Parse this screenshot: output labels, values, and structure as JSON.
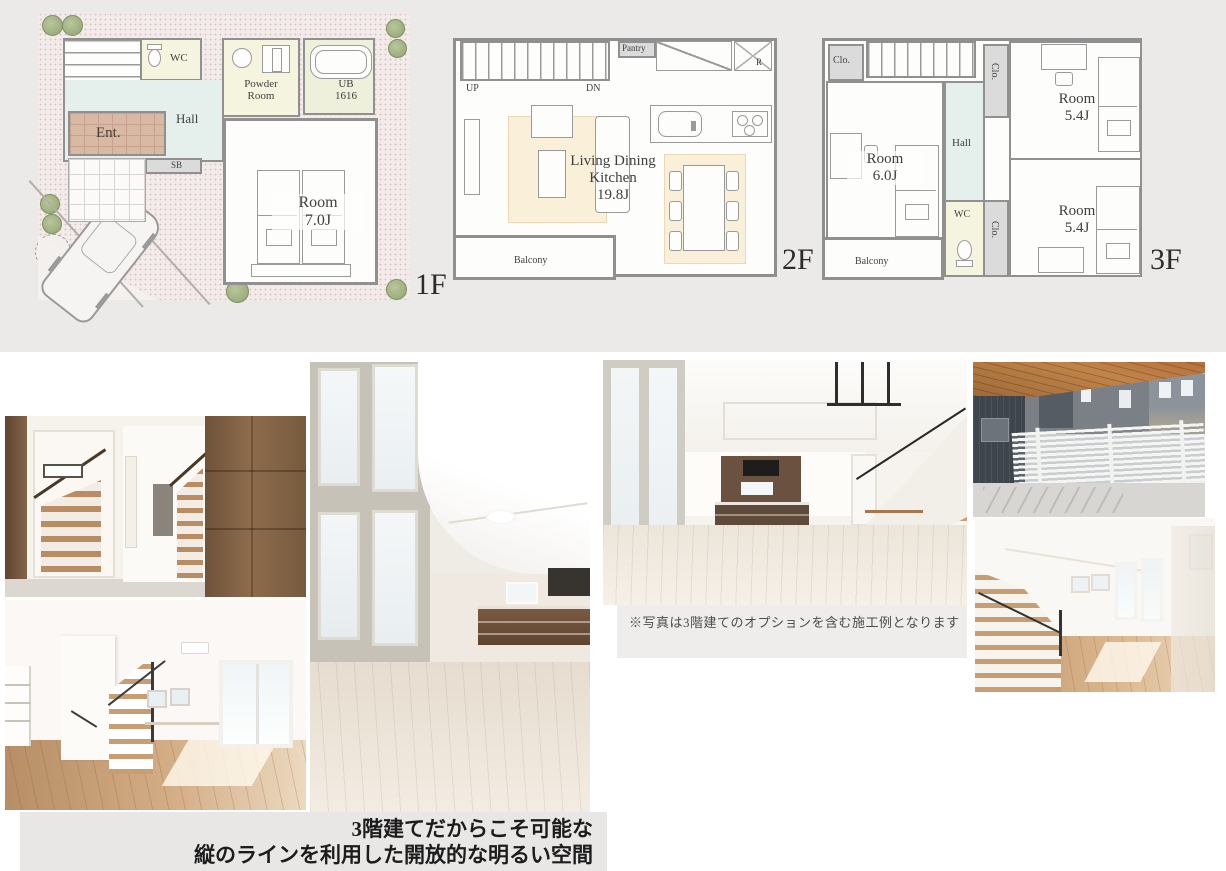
{
  "colors": {
    "plans_band_bg": "#ECE9E9",
    "site_dotted_bg": "#F2EBEA",
    "wall": "#8F8F8F",
    "hall_fill": "#E5F0ED",
    "wet_fill": "#F4F4DF",
    "entry_fill": "#D8B9A4",
    "closet_fill": "#DBDBDB",
    "rug_fill": "#FAF0DA",
    "tree_green": "#91A571",
    "caption_bg": "#EFEDEC",
    "title_band_bg": "#E9E7E6",
    "title_color": "#1C1C1C",
    "wood_dark": "#7D5F43",
    "balcony_ceiling_wood": "#B5713D"
  },
  "floor1": {
    "floor_label": "1F",
    "up": "UP",
    "wc": "WC",
    "powder": "Powder\nRoom",
    "ub": "UB\n1616",
    "hall": "Hall",
    "ent": "Ent.",
    "sb": "SB",
    "clo_a": "Clo.",
    "clo_b": "Clo.",
    "room": "Room\n7.0J"
  },
  "floor2": {
    "floor_label": "2F",
    "up": "UP",
    "dn": "DN",
    "pantry": "Pantry",
    "fridge": "R",
    "ldk": "Living Dining\nKitchen\n19.8J",
    "balcony": "Balcony"
  },
  "floor3": {
    "floor_label": "3F",
    "clo_top": "Clo.",
    "dn": "DN",
    "clo_rt": "Clo.",
    "room_tr": "Room\n5.4J",
    "hall": "Hall",
    "room_left": "Room\n6.0J",
    "wc": "WC",
    "clo_rb": "Clo.",
    "room_br": "Room\n5.4J",
    "balcony": "Balcony"
  },
  "gallery": {
    "note": "※写真は3階建てのオプションを含む施工例となります"
  },
  "title": {
    "line1": "3階建てだからこそ可能な",
    "line2": "縦のラインを利用した開放的な明るい空間"
  }
}
